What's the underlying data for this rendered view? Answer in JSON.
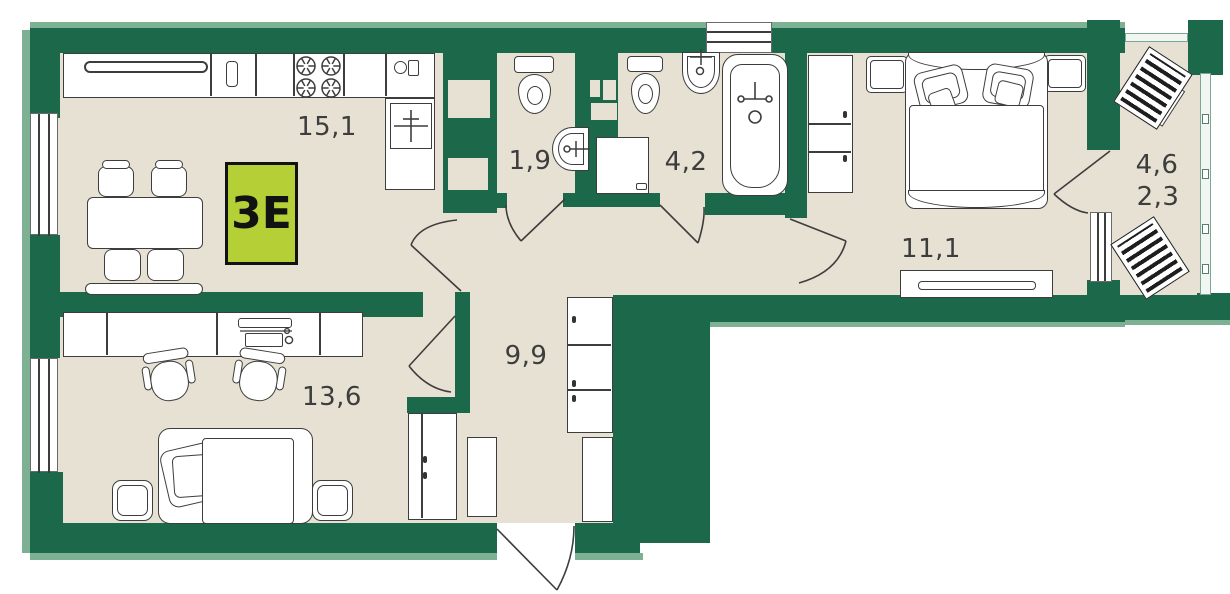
{
  "badge": {
    "label": "3Е"
  },
  "rooms": [
    {
      "name": "kitchen-living",
      "area": "15,1"
    },
    {
      "name": "wc",
      "area": "1,9"
    },
    {
      "name": "bathroom",
      "area": "4,2"
    },
    {
      "name": "bedroom",
      "area": "11,1"
    },
    {
      "name": "hall",
      "area": "9,9"
    },
    {
      "name": "room",
      "area": "13,6"
    }
  ],
  "balcony": {
    "area_total": "4,6",
    "area_coeff": "2,3"
  },
  "colors": {
    "wall_green": "#1c684a",
    "wall_light": "#7eb094",
    "floor_beige": "#e6e1d3",
    "line": "#3d3d3d",
    "badge_bg": "#b5cf36"
  }
}
